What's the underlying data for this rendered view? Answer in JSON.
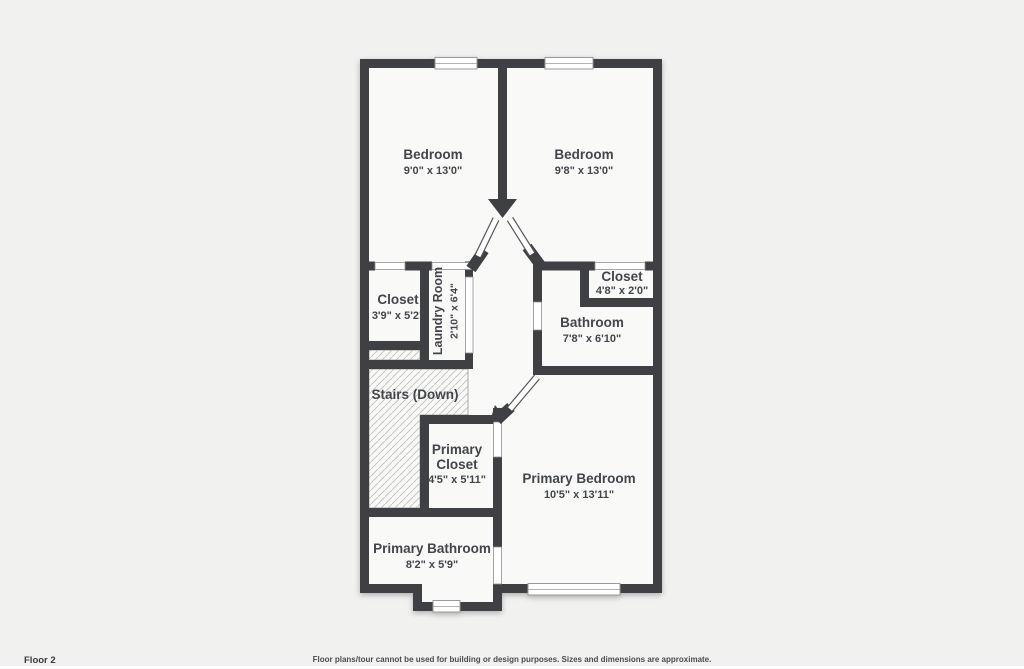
{
  "floor_plan": {
    "rooms": {
      "bedroom1": {
        "name": "Bedroom",
        "dims": "9'0\" x 13'0\""
      },
      "bedroom2": {
        "name": "Bedroom",
        "dims": "9'8\" x 13'0\""
      },
      "closet1": {
        "name": "Closet",
        "dims": "3'9\" x 5'2\""
      },
      "laundry": {
        "name": "Laundry Room",
        "dims": "2'10\" x 6'4\""
      },
      "closet2": {
        "name": "Closet",
        "dims": "4'8\" x 2'0\""
      },
      "bathroom": {
        "name": "Bathroom",
        "dims": "7'8\" x 6'10\""
      },
      "stairs": {
        "name": "Stairs (Down)"
      },
      "primary_closet": {
        "name_line1": "Primary",
        "name_line2": "Closet",
        "dims": "4'5\" x 5'11\""
      },
      "primary_bedroom": {
        "name": "Primary Bedroom",
        "dims": "10'5\" x 13'11\""
      },
      "primary_bathroom": {
        "name": "Primary Bathroom",
        "dims": "8'2\" x 5'9\""
      }
    },
    "footer": {
      "floor_label": "Floor 2",
      "disclaimer": "Floor plans/tour cannot be used for building or design purposes. Sizes and dimensions are approximate."
    },
    "colors": {
      "wall": "#3e4043",
      "room_fill": "#f9f9f8",
      "background": "#f1f1f0",
      "text": "#42464b"
    }
  }
}
